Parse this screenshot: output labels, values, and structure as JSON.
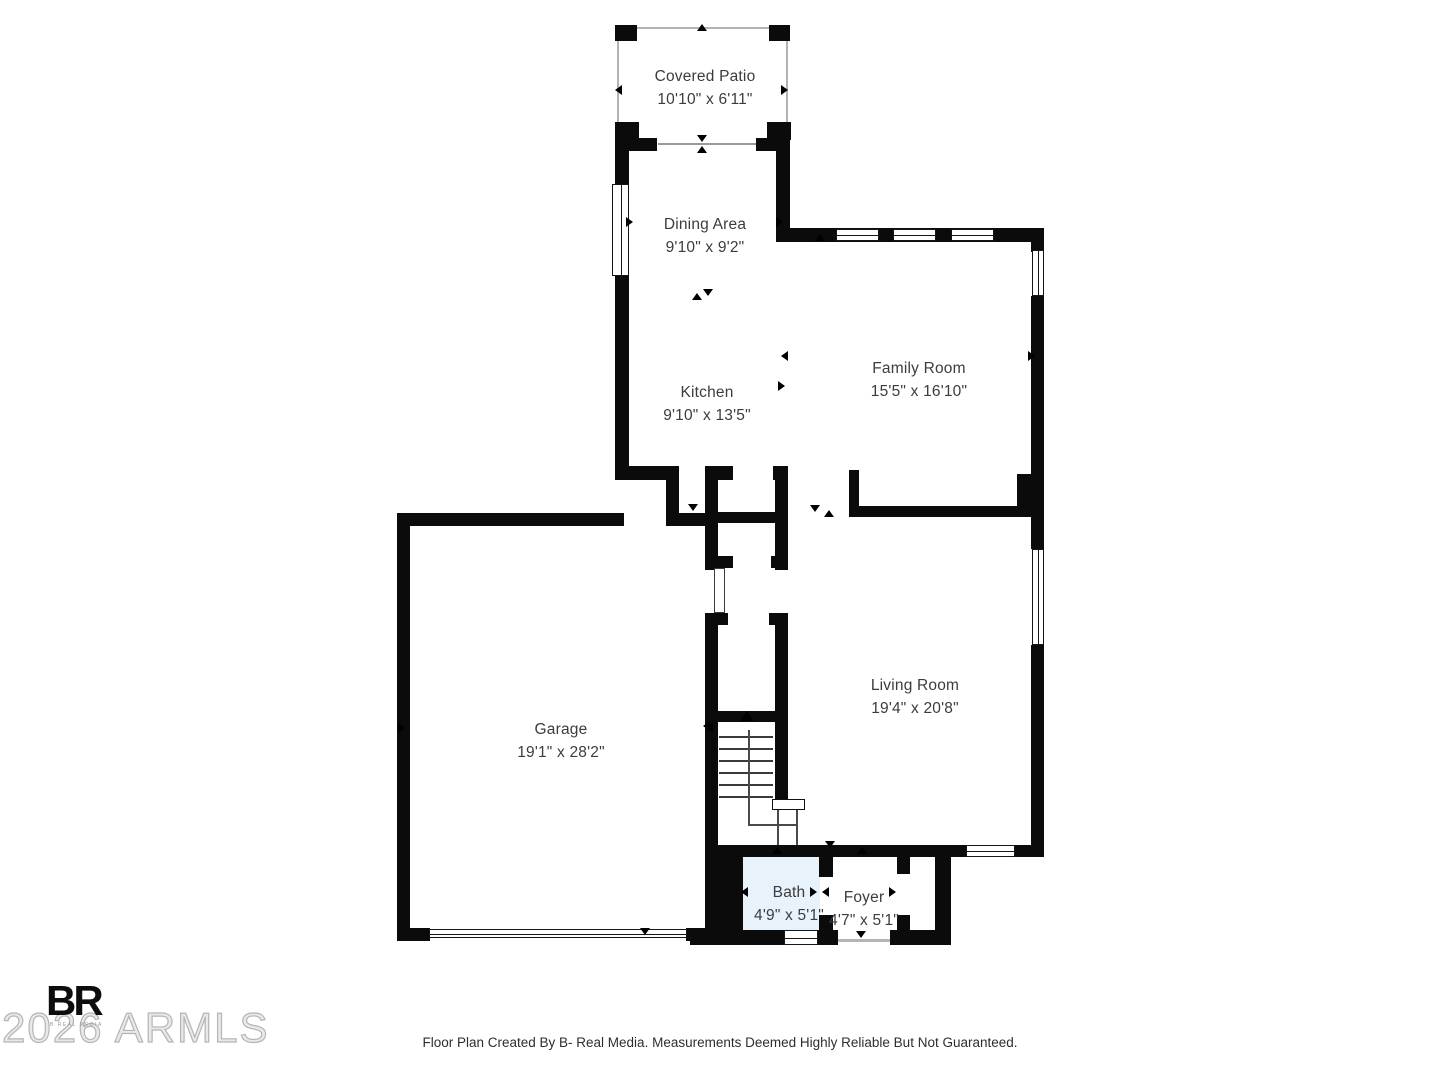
{
  "rooms": [
    {
      "name": "Covered Patio",
      "dims": "10'10\" x 6'11\""
    },
    {
      "name": "Dining Area",
      "dims": "9'10\" x 9'2\""
    },
    {
      "name": "Family Room",
      "dims": "15'5\" x 16'10\""
    },
    {
      "name": "Kitchen",
      "dims": "9'10\" x 13'5\""
    },
    {
      "name": "Garage",
      "dims": "19'1\" x 28'2\""
    },
    {
      "name": "Living Room",
      "dims": "19'4\" x 20'8\""
    },
    {
      "name": "Bath",
      "dims": "4'9\" x 5'1\""
    },
    {
      "name": "Foyer",
      "dims": "4'7\" x 5'1\""
    }
  ],
  "watermark": {
    "text": "2026 ARMLS"
  },
  "logo": {
    "text": "BR",
    "subtext": "B REAL MEDIA"
  },
  "footer": {
    "text": "Floor Plan Created By B- Real Media. Measurements Deemed Highly Reliable But Not Guaranteed."
  },
  "colors": {
    "wall": "#0b0b0b",
    "bath_fill": "#e8f2fb",
    "watermark": "#b5b5b5",
    "label_text": "#3c3c3c",
    "footer_text": "#2e2e2e"
  }
}
